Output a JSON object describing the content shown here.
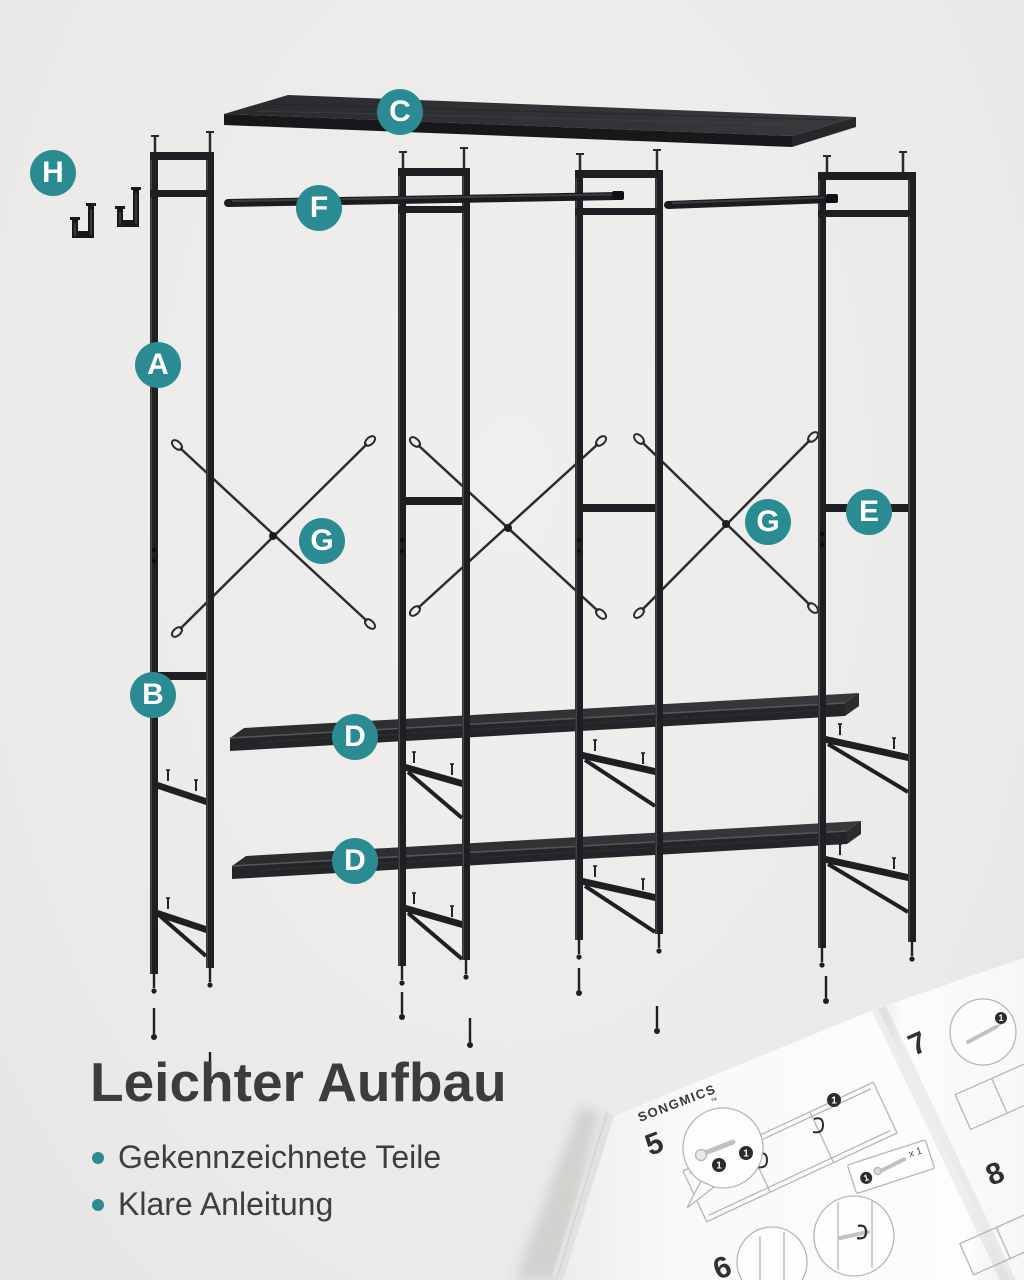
{
  "page": {
    "type": "product-assembly-exploded-diagram",
    "product": "garment rack with shelves"
  },
  "colors": {
    "accent_teal": "#2b8b92",
    "background": "#ebeae8",
    "metal_frame": "#1e1f23",
    "board_dark": "#2c2d30",
    "title_text": "#3c3c3c",
    "manual_line_art": "#b7b6b4"
  },
  "diagram": {
    "part_labels": [
      {
        "letter": "A"
      },
      {
        "letter": "B"
      },
      {
        "letter": "C"
      },
      {
        "letter": "D"
      },
      {
        "letter": "D"
      },
      {
        "letter": "E"
      },
      {
        "letter": "F"
      },
      {
        "letter": "G"
      },
      {
        "letter": "G"
      },
      {
        "letter": "H"
      }
    ]
  },
  "caption": {
    "title": "Leichter Aufbau",
    "bullets": [
      "Gekennzeichnete Teile",
      "Klare Anleitung"
    ]
  },
  "manual": {
    "brand": "SONGMICS",
    "trademark": "™",
    "steps": [
      "5",
      "6",
      "7",
      "8"
    ],
    "quantity_note": "x 1",
    "badge_number": "1"
  }
}
